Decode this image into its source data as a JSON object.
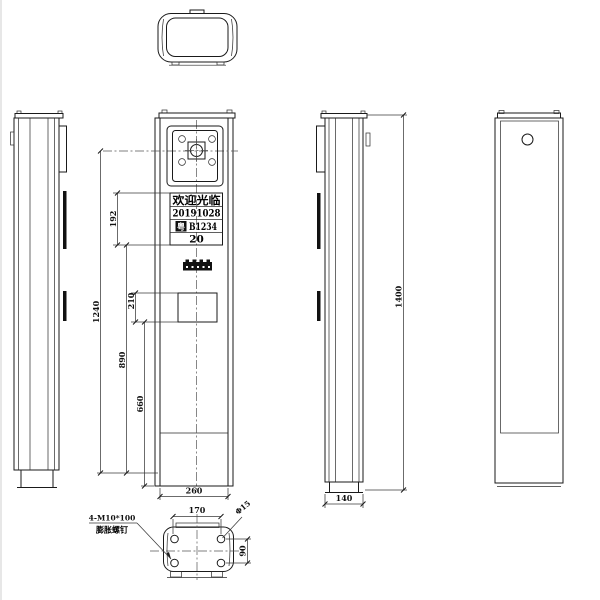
{
  "drawing": {
    "front_view": {
      "display": {
        "row1": "欢迎光临",
        "row2": "20191028",
        "plate_prefix": "粤",
        "plate_number": "B1234",
        "row4": "20"
      }
    },
    "dimensions": {
      "front_total_height": "1240",
      "display_height": "192",
      "lower_section_height": "890",
      "reader_window_height": "210",
      "base_section_height": "660",
      "front_width": "260",
      "side_depth": "140",
      "overall_height": "1400",
      "anchor_hole_pitch_width": "170",
      "anchor_hole_pitch_depth": "90",
      "anchor_hole_diameter": "Φ15"
    },
    "anchor_note": {
      "line1": "4-M10*100",
      "line2": "膨胀螺钉"
    },
    "colors": {
      "background": "#ffffff",
      "object_line": "#1a1a1a",
      "dimension_line": "#3a3a3a"
    }
  }
}
